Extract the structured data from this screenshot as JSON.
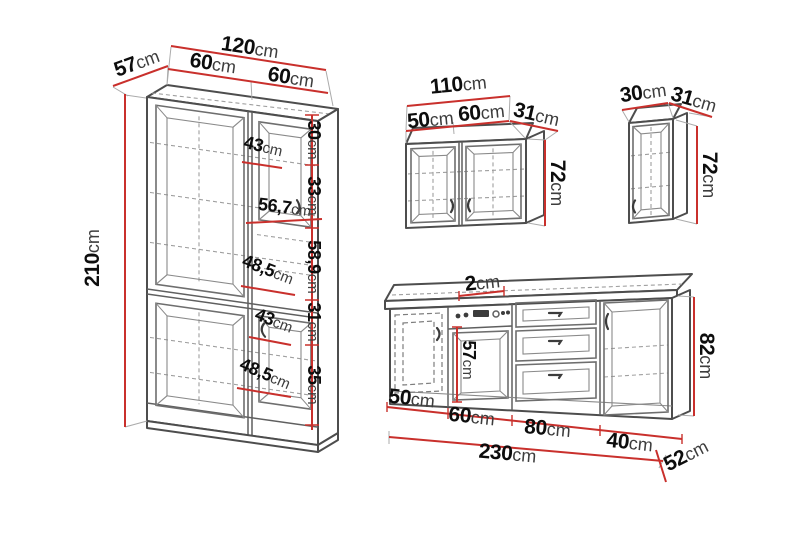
{
  "colors": {
    "dimension_line": "#c9302c",
    "drawing_line": "#4d4d4d",
    "text": "#0d0d0d"
  },
  "units": {
    "tall": {
      "total_width": {
        "value": "120",
        "unit": "cm"
      },
      "depth": {
        "value": "57",
        "unit": "cm"
      },
      "left_width": {
        "value": "60",
        "unit": "cm"
      },
      "right_width": {
        "value": "60",
        "unit": "cm"
      },
      "height": {
        "value": "210",
        "unit": "cm"
      },
      "seg1": {
        "value": "30",
        "unit": "cm"
      },
      "seg2": {
        "value": "33",
        "unit": "cm"
      },
      "niche_height": {
        "value": "56,7",
        "unit": "cm"
      },
      "seg3": {
        "value": "58,9",
        "unit": "cm"
      },
      "seg4": {
        "value": "31",
        "unit": "cm"
      },
      "seg5": {
        "value": "35",
        "unit": "cm"
      },
      "door1_inner": {
        "value": "43",
        "unit": "cm"
      },
      "shelf1_inner": {
        "value": "48,5",
        "unit": "cm"
      },
      "door2_inner": {
        "value": "43",
        "unit": "cm"
      },
      "shelf2_inner": {
        "value": "48,5",
        "unit": "cm"
      }
    },
    "wall_double": {
      "total_width": {
        "value": "110",
        "unit": "cm"
      },
      "left_width": {
        "value": "50",
        "unit": "cm"
      },
      "right_width": {
        "value": "60",
        "unit": "cm"
      },
      "depth": {
        "value": "31",
        "unit": "cm"
      },
      "height": {
        "value": "72",
        "unit": "cm"
      }
    },
    "wall_single": {
      "width": {
        "value": "30",
        "unit": "cm"
      },
      "depth": {
        "value": "31",
        "unit": "cm"
      },
      "height": {
        "value": "72",
        "unit": "cm"
      }
    },
    "base": {
      "worktop_thickness": {
        "value": "2",
        "unit": "cm"
      },
      "oven_niche_height": {
        "value": "57",
        "unit": "cm"
      },
      "height": {
        "value": "82",
        "unit": "cm"
      },
      "seg1": {
        "value": "50",
        "unit": "cm"
      },
      "seg2": {
        "value": "60",
        "unit": "cm"
      },
      "seg3": {
        "value": "80",
        "unit": "cm"
      },
      "seg4": {
        "value": "40",
        "unit": "cm"
      },
      "total_width": {
        "value": "230",
        "unit": "cm"
      },
      "depth": {
        "value": "52",
        "unit": "cm"
      }
    }
  }
}
